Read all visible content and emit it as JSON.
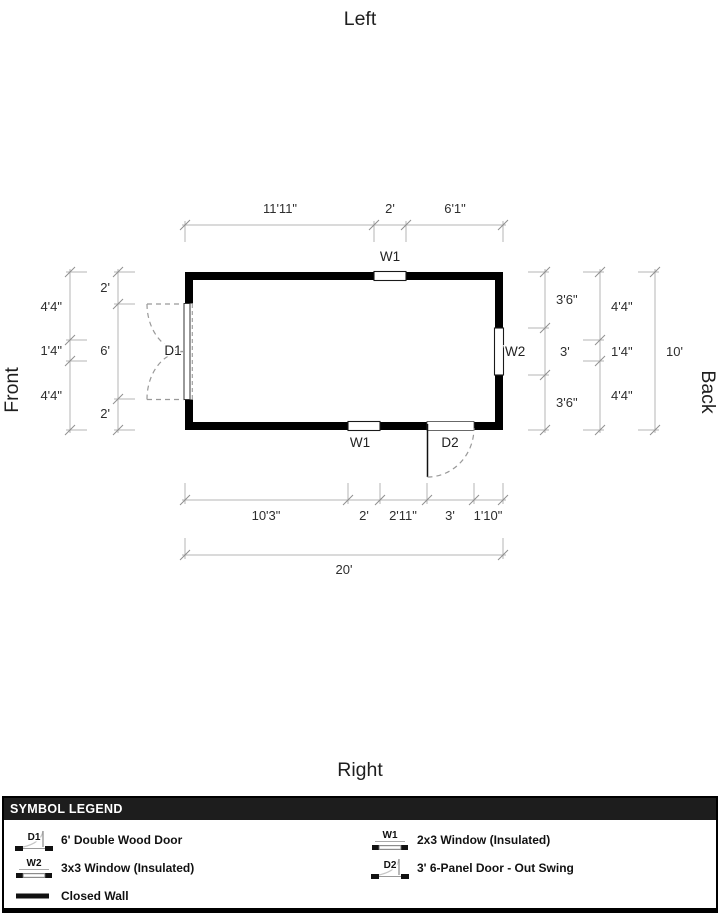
{
  "orientation": {
    "top": "Left",
    "bottom": "Right",
    "left": "Front",
    "right": "Back"
  },
  "plan_labels": {
    "window_top": "W1",
    "window_bottom": "W1",
    "window_right": "W2",
    "door_left": "D1",
    "door_bottom": "D2"
  },
  "dimensions": {
    "top": [
      "11'11\"",
      "2'",
      "6'1\""
    ],
    "left_outer": [
      "4'4\"",
      "1'4\"",
      "4'4\""
    ],
    "left_inner": [
      "2'",
      "6'",
      "2'"
    ],
    "right_inner": [
      "3'6\"",
      "3'",
      "3'6\""
    ],
    "right_mid": [
      "4'4\"",
      "1'4\"",
      "4'4\""
    ],
    "right_outer": "10'",
    "bottom_inner": [
      "10'3\"",
      "2'",
      "2'11\"",
      "3'",
      "1'10\""
    ],
    "bottom_outer": "20'"
  },
  "legend": {
    "title": "SYMBOL LEGEND",
    "items": [
      {
        "symbol": "D1",
        "label": "6' Double Wood Door"
      },
      {
        "symbol": "W1",
        "label": "2x3 Window (Insulated)"
      },
      {
        "symbol": "W2",
        "label": "3x3 Window (Insulated)"
      },
      {
        "symbol": "D2",
        "label": "3' 6-Panel Door - Out Swing"
      },
      {
        "symbol": "",
        "label": "Closed Wall"
      }
    ]
  },
  "colors": {
    "wall": "#000000",
    "dimension_line": "#b5b5b5",
    "swing_dash": "#999999",
    "legend_header_bg": "#1d1d1d",
    "legend_header_text": "#ffffff"
  }
}
